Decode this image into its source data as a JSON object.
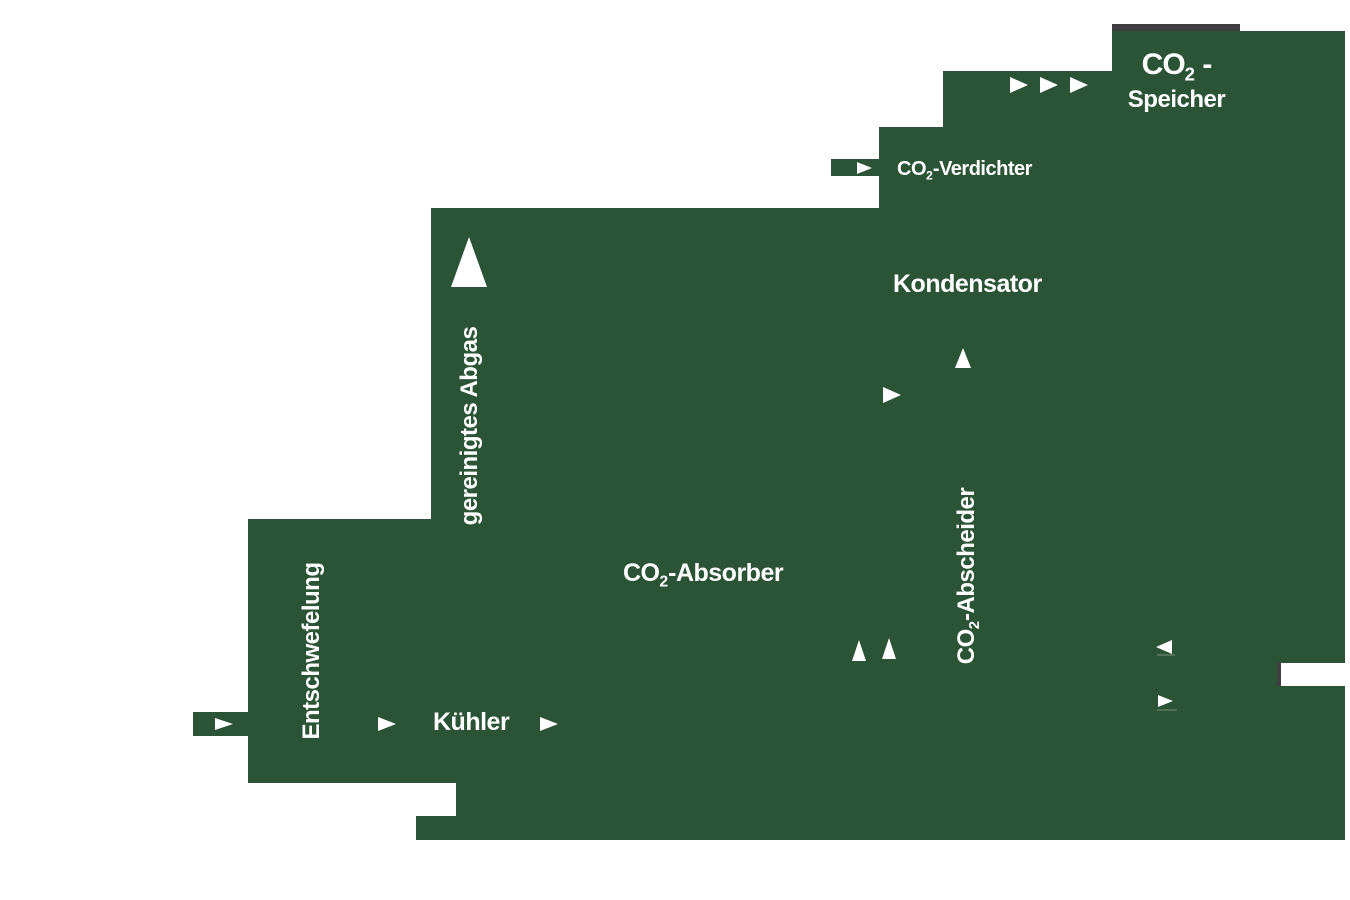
{
  "diagram": {
    "background": "#ffffff",
    "colors": {
      "block": "#2B5335",
      "bar": "#3F3F3F",
      "text": "#FFFFFF"
    },
    "labels": {
      "speicher_line1": {
        "pre": "CO",
        "sub": "2",
        "post": " -"
      },
      "speicher_line2": "Speicher",
      "verdichter": {
        "pre": "CO",
        "sub": "2",
        "post": "-Verdichter"
      },
      "kondensator": "Kondensator",
      "abscheider": {
        "pre": "CO",
        "sub": "2",
        "post": "-Abscheider"
      },
      "absorber": {
        "pre": "CO",
        "sub": "2",
        "post": "-Absorber"
      },
      "kuehler": "Kühler",
      "entschwefelung": "Entschwefelung",
      "gereinigtes_abgas": "gereinigtes Abgas"
    },
    "icons": {
      "arrow_right": "triangle-right",
      "arrow_up": "triangle-up",
      "arrow_left": "triangle-left"
    }
  }
}
